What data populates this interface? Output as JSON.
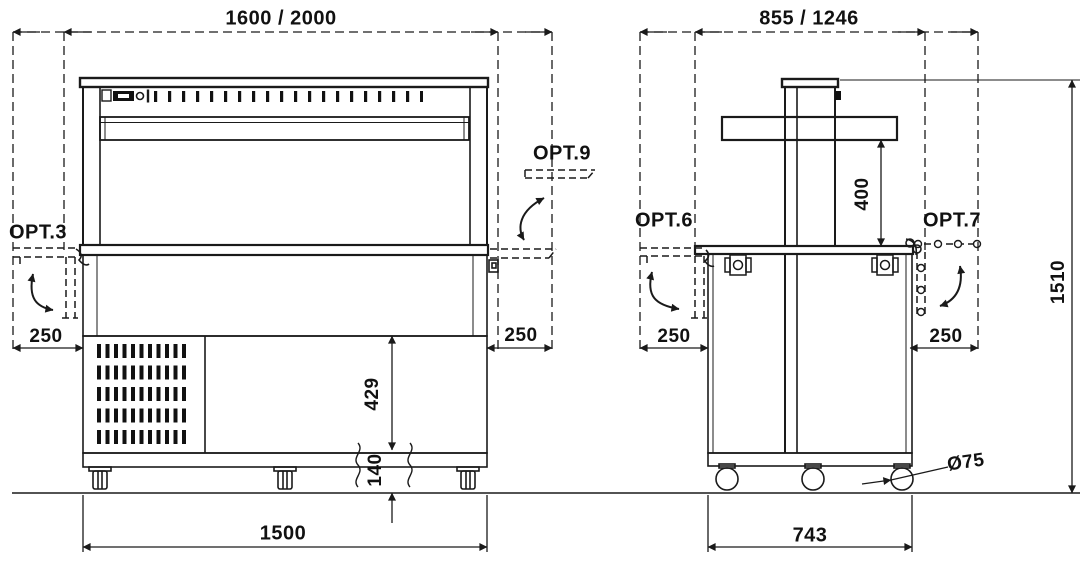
{
  "drawing_type": "technical-dimension-drawing",
  "front_view": {
    "top_width_dim": "1600 / 2000",
    "base_width_dim": "1500",
    "left_shelf_label": "OPT.3",
    "right_shelf_label": "OPT.9",
    "left_shelf_depth": "250",
    "right_shelf_depth": "250",
    "body_height_dim": "429",
    "caster_height_dim": "140"
  },
  "side_view": {
    "top_depth_dim": "855 / 1246",
    "base_depth_dim": "743",
    "left_shelf_label": "OPT.6",
    "right_shelf_label": "OPT.7",
    "left_shelf_depth": "250",
    "right_shelf_depth": "250",
    "canopy_height_dim": "400",
    "overall_height_dim": "1510",
    "caster_diameter_dim": "Ø75"
  },
  "colors": {
    "line": "#1a1a1a",
    "background": "#ffffff"
  }
}
